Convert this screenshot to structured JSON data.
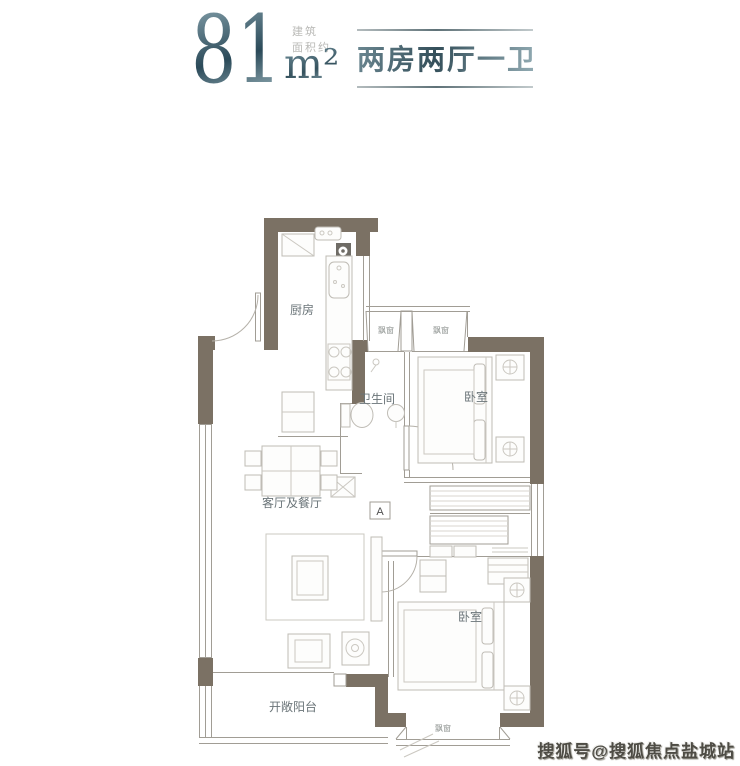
{
  "header": {
    "area_value": "81",
    "area_note": [
      "建筑",
      "面积约"
    ],
    "area_unit": "m²",
    "layout_badge": "两房两厅一卫"
  },
  "floorplan": {
    "labels": {
      "kitchen": "厨房",
      "bathroom": "卫生间",
      "bedroom_top": "卧室",
      "living_dining": "客厅及餐厅",
      "bedroom_bottom": "卧室",
      "balcony": "开敞阳台",
      "bay_window": "飘窗",
      "section_marker": "A"
    }
  },
  "watermark": "搜狐号@搜狐焦点盐城站",
  "colors": {
    "wall": "#7b7164",
    "thin_line": "#a19d95",
    "furniture_line": "#bfbcb5",
    "label_text": "#6a7478",
    "accent_dark": "#2b4a59",
    "accent_light": "#a3bcc3",
    "watermark_text": "#4e4c45"
  }
}
